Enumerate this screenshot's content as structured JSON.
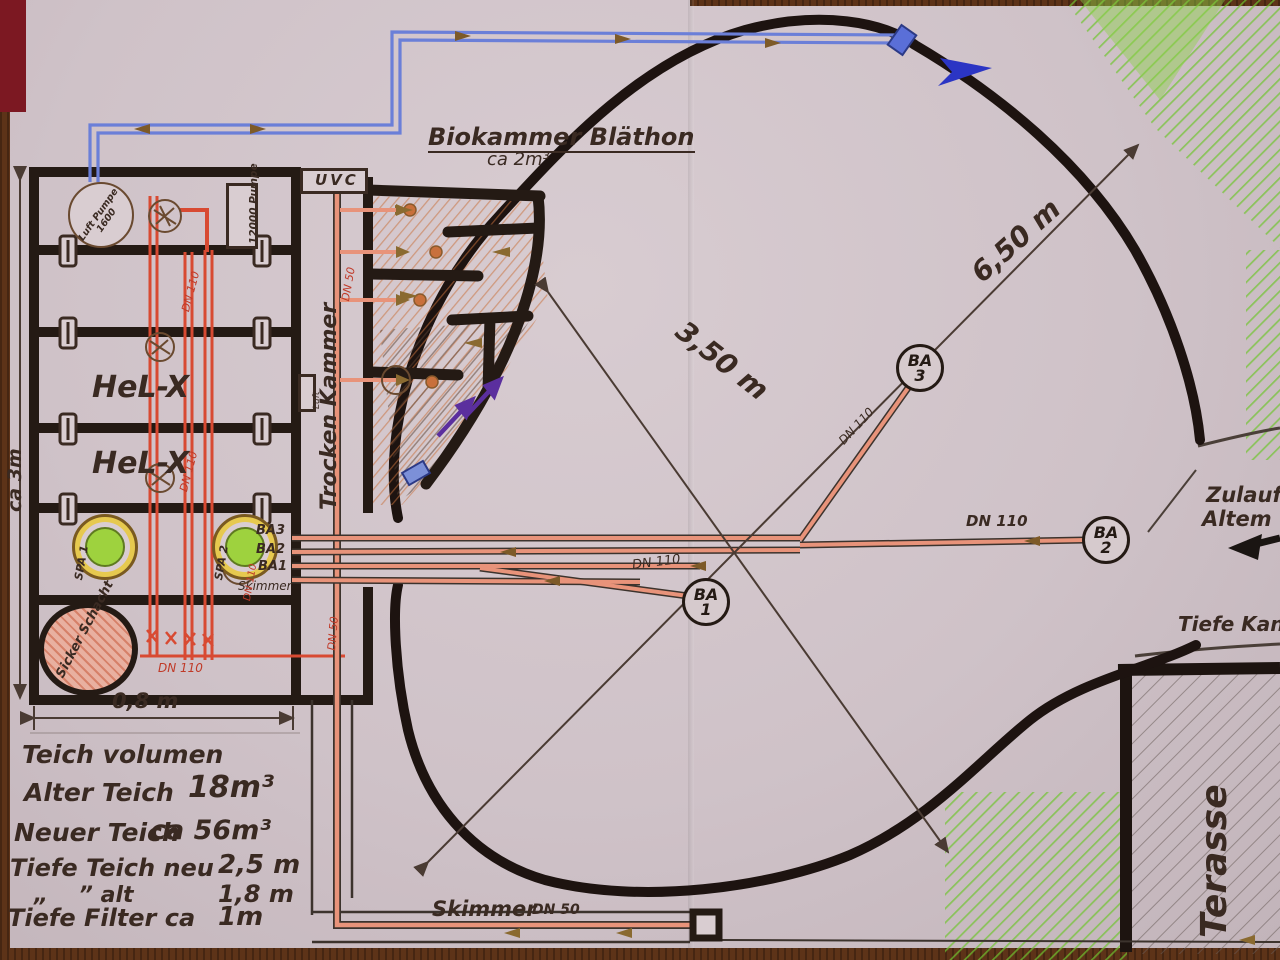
{
  "meta": {
    "description": "Hand-drawn koi pond and filter construction plan (photographed paper sketch)"
  },
  "colors": {
    "paper": "#cfc2c8",
    "ink": "#3a2a22",
    "pipe_red": "#d84a32",
    "pipe_salmon": "#e8937a",
    "pipe_blue": "#6b7fd8",
    "arrow_purple": "#5b2f9e",
    "arrow_blue": "#2b35c4",
    "green": "#6fc42e",
    "wood": "#5d3318"
  },
  "filter": {
    "luft_pumpe": "Luft Pumpe 1600",
    "pumpe_12000": "12000 Pumpe",
    "uvc": "UVC",
    "trocken_kammer": "Trocken Kammer",
    "helx": "HeL-X",
    "luft": "Luft",
    "spa1": "SPA 1",
    "spa2": "SPA 2",
    "sicker_schacht": "Sicker Schacht",
    "biokammer_title": "Biokammer Bläthon",
    "biokammer_sub": "ca 2m³"
  },
  "pond": {
    "ba": "BA",
    "ba1_no": "1",
    "ba2_no": "2",
    "ba3_no": "3",
    "zulauf_line1": "Zulauf",
    "zulauf_line2": "Altem",
    "tiefe_kanal": "Tiefe Kanal",
    "terasse": "Terasse",
    "skimmer": "Skimmer"
  },
  "pipes": {
    "dn110": "DN 110",
    "dn50": "DN 50",
    "end_ba3": "BA3",
    "end_ba2": "BA2",
    "end_ba1": "BA1",
    "end_skimmer": "Skimmer"
  },
  "dimensions": {
    "d650": "6,50 m",
    "d350": "3,50 m",
    "d08": "0,8 m",
    "ca3m": "ca 3m"
  },
  "notes": {
    "title": "Teich volumen",
    "l2": "Alter Teich",
    "v2": "18m³",
    "l3": "Neuer Teich",
    "v3": "ca 56m³",
    "l4": "Tiefe Teich neu",
    "v4": "2,5 m",
    "l5": "„    ” alt",
    "v5": "1,8 m",
    "l6": "Tiefe Filter ca",
    "v6": "1m"
  }
}
